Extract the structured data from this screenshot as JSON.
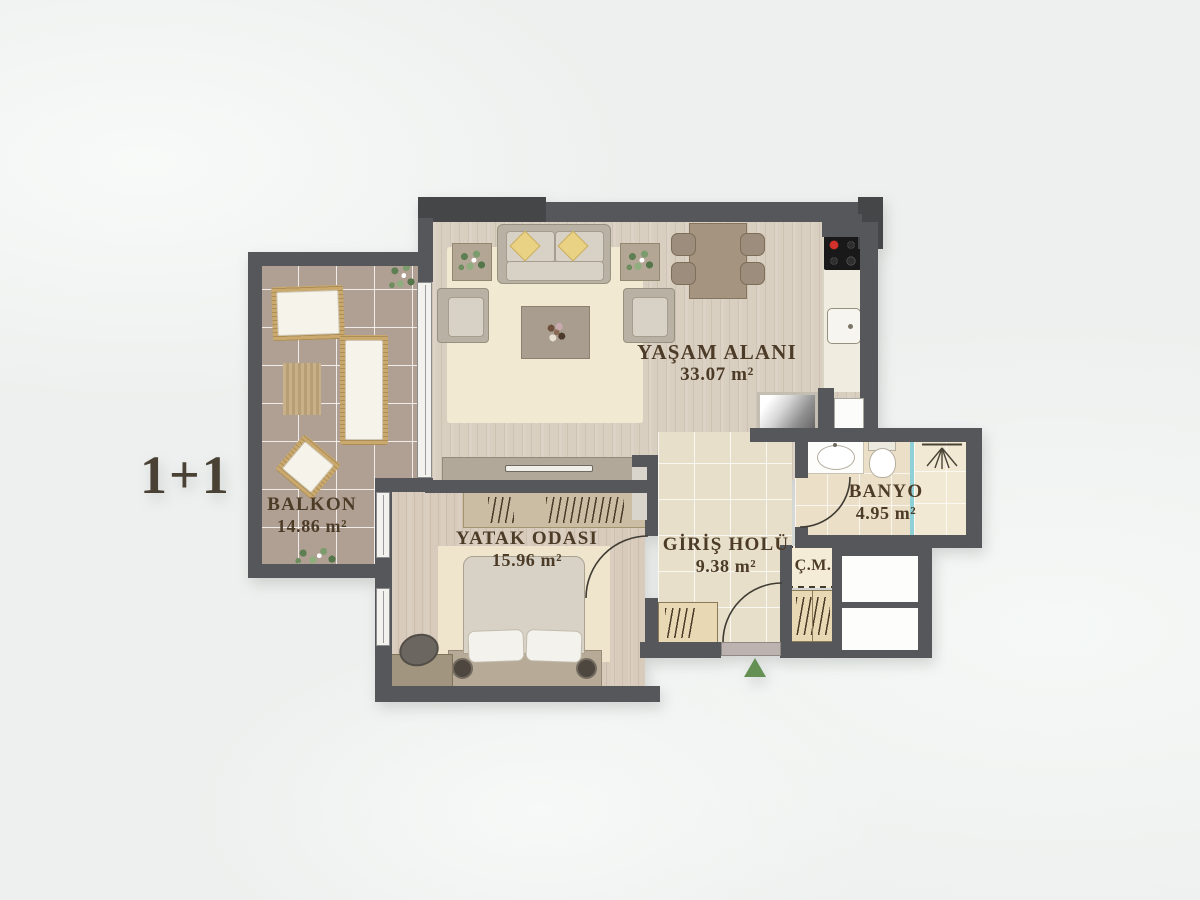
{
  "plan": {
    "title": "1+1",
    "rooms": {
      "living": {
        "name": "YAŞAM ALANI",
        "area": "33.07 m²"
      },
      "balcony": {
        "name": "BALKON",
        "area": "14.86 m²"
      },
      "bedroom": {
        "name": "YATAK ODASI",
        "area": "15.96 m²"
      },
      "hall": {
        "name": "GİRİŞ HOLÜ",
        "area": "9.38 m²"
      },
      "bathroom": {
        "name": "BANYO",
        "area": "4.95 m²"
      },
      "laundry": {
        "name": "Ç.M."
      }
    },
    "icons": {
      "entrance_marker": "triangle-up",
      "shower": "shower-head",
      "stove": "cooktop-4-burners",
      "plants": "potted-plant"
    },
    "colors": {
      "wall": "#56575a",
      "entrance_green": "#649153",
      "shower_teal": "#8fd0d6",
      "label_text": "#4c3b26",
      "stove_burner_red": "#d3312b"
    }
  }
}
